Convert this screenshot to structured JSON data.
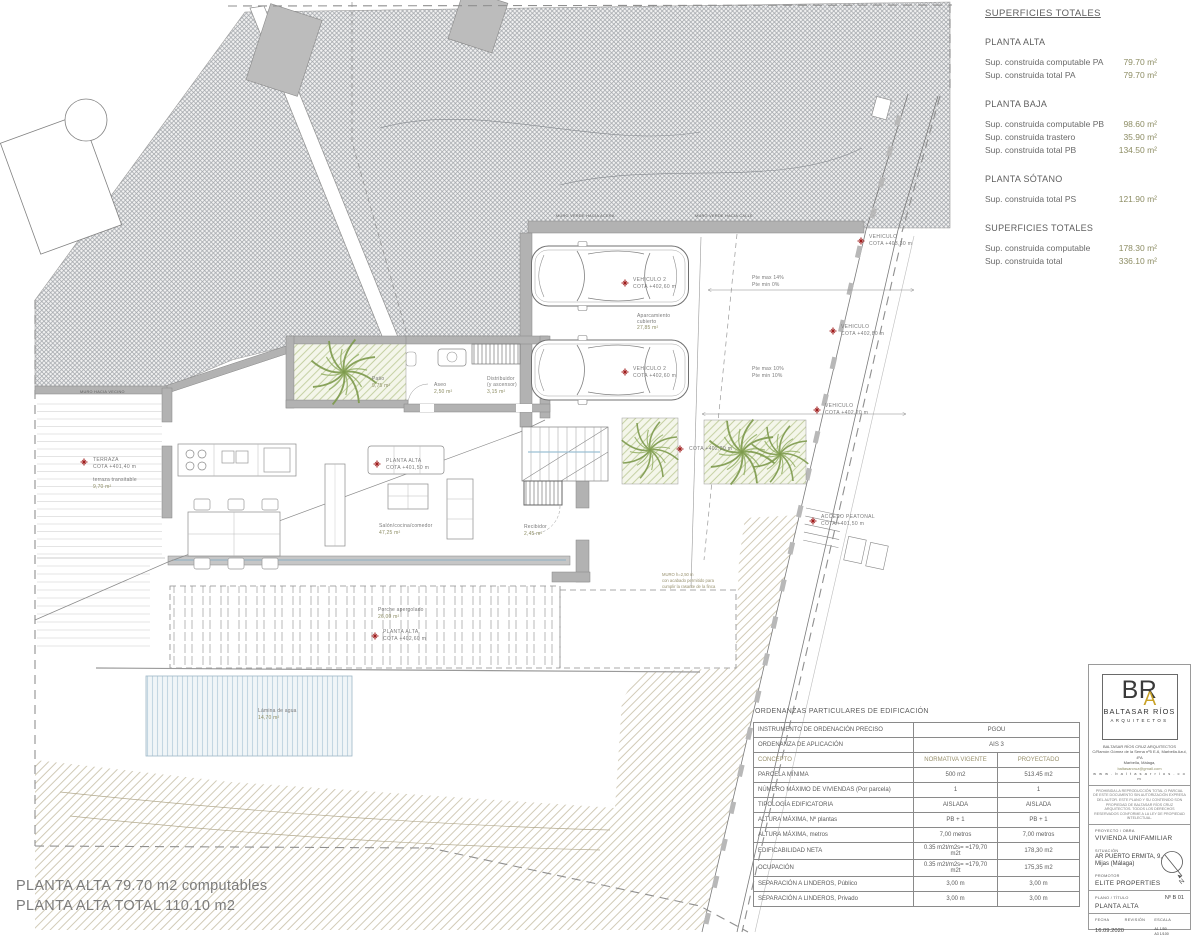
{
  "plan": {
    "labels": {
      "veh_top": {
        "l1": "VEHICULO 2",
        "l2": "COTA +402,60 m"
      },
      "veh_bottom": {
        "l1": "VEHICULO 2",
        "l2": "COTA +402,60 m"
      },
      "aparcamiento": {
        "l1": "Aparcamiento",
        "l2": "cubierto",
        "l3": "27,85 m²"
      },
      "pte_upper": {
        "l1": "Pte max 14%",
        "l2": "Pte min 0%"
      },
      "pte_lower": {
        "l1": "Pte max 10%",
        "l2": "Pte min 10%"
      },
      "veh_403": {
        "l1": "VEHICULO",
        "l2": "COTA +403,30 m"
      },
      "veh_40280": {
        "l1": "VEHICULO",
        "l2": "COTA +402,80 m"
      },
      "veh_40220": {
        "l1": "VEHICULO",
        "l2": "COTA +402,20 m"
      },
      "acceso": {
        "l1": "ACCESO PEATONAL",
        "l2": "COTA +401,50 m"
      },
      "cota_mid": {
        "l1": "COTA +402,20 m"
      },
      "planta_alta": {
        "l1": "PLANTA ALTA",
        "l2": "COTA +401,50 m"
      },
      "patio": {
        "l1": "Patio",
        "l2": "9,75 m²"
      },
      "aseo": {
        "l1": "Aseo",
        "l2": "2,50 m²"
      },
      "distribuidor": {
        "l1": "Distribuidor",
        "l2": "(y ascensor)",
        "l3": "3,15 m²"
      },
      "salon": {
        "l1": "Salón/cocina/comedor",
        "l2": "47,25 m²"
      },
      "recibidor": {
        "l1": "Recibidor",
        "l2": "2,45 m²"
      },
      "terraza": {
        "l1": "TERRAZA",
        "l2": "COTA +401,40 m"
      },
      "terraza_transitable": {
        "l1": "terraza transitable",
        "l2": "9,70 m²"
      },
      "porche": {
        "l1": "Porche apergolado",
        "l2": "26,00 m²"
      },
      "planta_alta_porche": {
        "l1": "PLANTA ALTA",
        "l2": "COTA +402,60 m"
      },
      "lamina": {
        "l1": "Lámina de agua",
        "l2": "14,70 m²"
      },
      "muro_nota": {
        "l1": "MURO  h=2,50 m",
        "l2": "con acabado permitido para",
        "l3": "cumplir la rasante de la finca"
      },
      "muro_verde_1": "MURO VERDE HACIA ACERA",
      "muro_verde_2": "MURO VERDE HACIA CALLE",
      "muro_vecino": "MURO HACIA VECINO"
    }
  },
  "superficies": {
    "title": "SUPERFICIES TOTALES",
    "sections": [
      {
        "heading": "PLANTA ALTA",
        "rows": [
          {
            "label": "Sup. construida computable PA",
            "value": "79.70 m²"
          },
          {
            "label": "Sup. construida total PA",
            "value": "79.70 m²"
          }
        ]
      },
      {
        "heading": "PLANTA BAJA",
        "rows": [
          {
            "label": "Sup. construida computable PB",
            "value": "98.60 m²"
          },
          {
            "label": "Sup. construida trastero",
            "value": "35.90 m²"
          },
          {
            "label": "Sup. construida total PB",
            "value": "134.50 m²"
          }
        ]
      },
      {
        "heading": "PLANTA SÓTANO",
        "rows": [
          {
            "label": "Sup. construida total PS",
            "value": "121.90 m²"
          }
        ]
      },
      {
        "heading": "SUPERFICIES TOTALES",
        "rows": [
          {
            "label": "Sup. construida computable",
            "value": "178.30 m²"
          },
          {
            "label": "Sup. construida total",
            "value": "336.10 m²"
          }
        ]
      }
    ]
  },
  "ordenanzas": {
    "title": "ORDENANZAS PARTICULARES DE EDIFICACIÓN",
    "span_rows": [
      {
        "label": "INSTRUMENTO DE ORDENACIÓN PRECISO",
        "value": "PGOU"
      },
      {
        "label": "ORDENANZA DE APLICACIÓN",
        "value": "AIS 3"
      }
    ],
    "header": {
      "c0": "CONCEPTO",
      "c1": "NORMATIVA VIGENTE",
      "c2": "PROYECTADO"
    },
    "rows": [
      {
        "c0": "PARCELA MÍNIMA",
        "c1": "500 m2",
        "c2": "513.45 m2"
      },
      {
        "c0": "NÚMERO MÁXIMO DE VIVIENDAS (Por parcela)",
        "c1": "1",
        "c2": "1"
      },
      {
        "c0": "TIPOLOGÍA EDIFICATORIA",
        "c1": "AISLADA",
        "c2": "AISLADA"
      },
      {
        "c0": "ALTURA MÁXIMA, Nº plantas",
        "c1": "PB + 1",
        "c2": "PB + 1"
      },
      {
        "c0": "ALTURA MÁXIMA, metros",
        "c1": "7,00 metros",
        "c2": "7,00 metros"
      },
      {
        "c0": "EDIFICABILIDAD NETA",
        "c1": "0.35 m2t/m2s= =179,70 m2t",
        "c2": "178,30 m2"
      },
      {
        "c0": "OCUPACIÓN",
        "c1": "0.35 m2t/m2s= =179,70 m2t",
        "c2": "175,35 m2"
      },
      {
        "c0": "SEPARACIÓN A LINDEROS, Público",
        "c1": "3,00 m",
        "c2": "3,00 m"
      },
      {
        "c0": "SEPARACIÓN A LINDEROS, Privado",
        "c1": "3,00 m",
        "c2": "3,00 m"
      }
    ]
  },
  "titleblock": {
    "logo": {
      "br": "BR",
      "a": "A",
      "name": "BALTASAR RÍOS",
      "sub": "ARQUITECTOS"
    },
    "firm": [
      "BALTASAR RÍOS CRUZ  ARQUITECTOS",
      "C/Ramón Gómez de la Serna nº5 E-6, Marbella Azul, 4ºA",
      "Marbella, Málaga,",
      "baltasarcruz@gmail.com",
      "w w w . b a l t a s a r r i o s . c o m"
    ],
    "legal": "PROHIBIDA LA REPRODUCCIÓN TOTAL O PARCIAL DE ESTE DOCUMENTO SIN AUTORIZACIÓN EXPRESA DEL AUTOR. ESTE PLANO Y SU CONTENIDO SON PROPIEDAD DE BALTASAR RÍOS CRUZ ARQUITECTOS. TODOS LOS DERECHOS RESERVADOS CONFORME A LA LEY DE PROPIEDAD INTELECTUAL.",
    "proyecto_label": "PROYECTO / OBRA",
    "proyecto": "VIVIENDA UNIFAMILIAR",
    "situacion_label": "SITUACIÓN",
    "situacion1": "AR PUERTO ERMITA, 9,",
    "situacion2": "Mijas (Málaga)",
    "promotor_label": "PROMOTOR",
    "promotor": "ELITE PROPERTIES",
    "plano_label": "PLANO / TÍTULO",
    "plano": "PLANTA ALTA",
    "num_label": "Nº",
    "num": "B 01",
    "fecha_label": "FECHA",
    "fecha": "16.09.2020",
    "revision_label": "REVISIÓN",
    "escala_label": "ESCALA",
    "escala1": "A1 1/50",
    "escala2": "A3 1/100",
    "north": "N"
  },
  "footer": {
    "line1": "PLANTA ALTA 79.70 m2 computables",
    "line2": "PLANTA ALTA TOTAL  110.10 m2"
  },
  "colors": {
    "value_olive": "#8d8d64",
    "label_gray": "#7a7a7a",
    "marker_red": "#a01d1d",
    "logo_gold": "#c9a227"
  }
}
